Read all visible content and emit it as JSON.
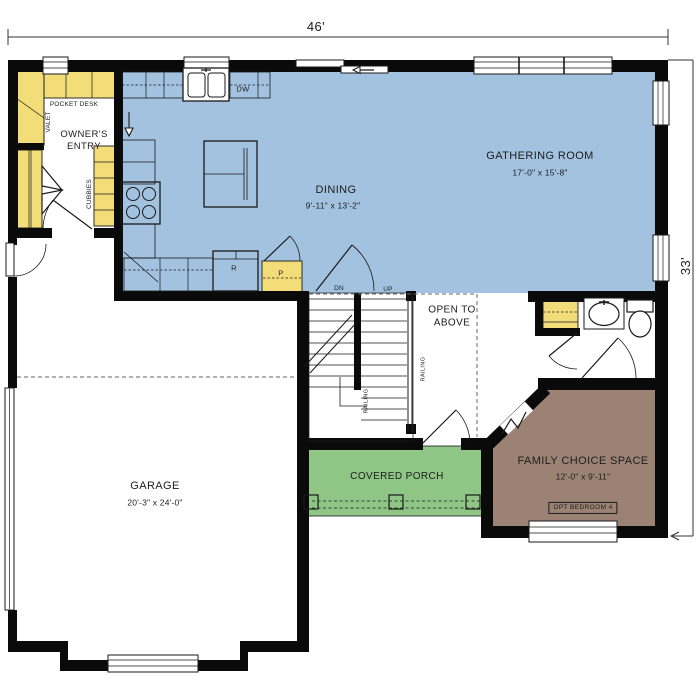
{
  "plan": {
    "title": "First floor plan",
    "dimensions": {
      "width": "46'",
      "height": "33'"
    },
    "rooms": {
      "gathering": {
        "name": "GATHERING ROOM",
        "dims": "17'-0\" x 15'-8\""
      },
      "dining": {
        "name": "DINING",
        "dims": "9'-11\" x 13'-2\""
      },
      "garage": {
        "name": "GARAGE",
        "dims": "20'-3\" x 24'-0\""
      },
      "family": {
        "name": "FAMILY CHOICE SPACE",
        "dims": "12'-0\" x 9'-11\"",
        "option": "OPT BEDROOM 4"
      },
      "porch": {
        "name": "COVERED PORCH"
      },
      "owners_entry": {
        "name": "OWNER'S ENTRY"
      },
      "open_to_above": {
        "name": "OPEN TO ABOVE"
      }
    },
    "labels": {
      "pocket_desk": "POCKET DESK",
      "valet": "VALET",
      "cubbies": "CUBBIES",
      "dishwasher": "DW",
      "refrigerator": "R",
      "pantry": "P",
      "down": "DN",
      "up": "UP",
      "railing": "RAILING"
    },
    "colors": {
      "living": "#a3c2e0",
      "cabinet": "#f2dd78",
      "porch": "#8fc585",
      "family": "#9b8274",
      "wall": "#0a0a0a"
    }
  }
}
